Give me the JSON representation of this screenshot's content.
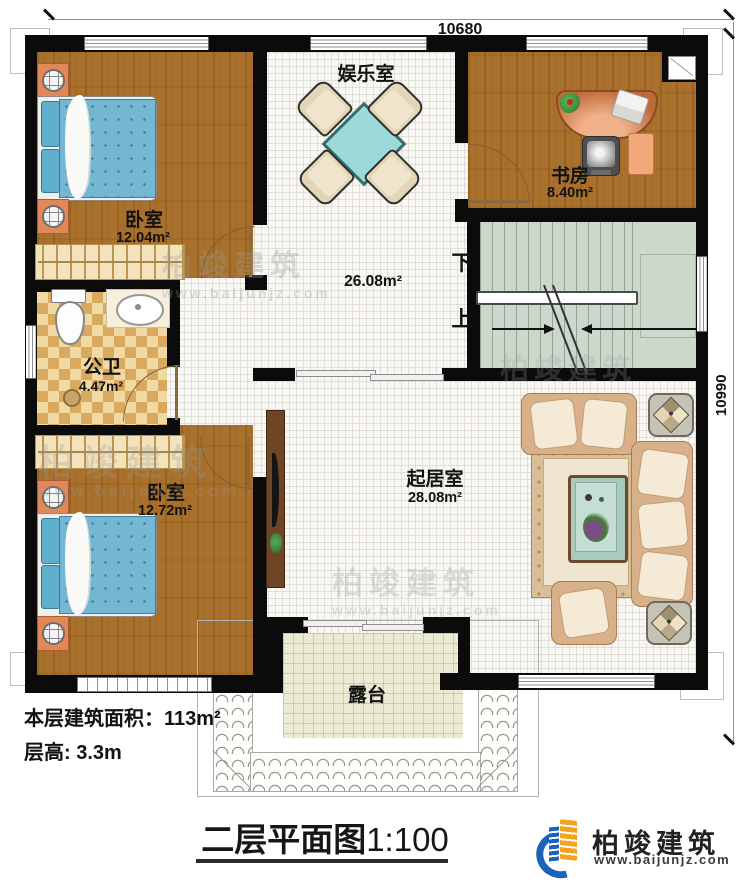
{
  "dimensions": {
    "top": "10680",
    "right": "10990"
  },
  "rooms": {
    "bedroom1": {
      "name": "卧室",
      "area": "12.04m²"
    },
    "entertainment": {
      "name": "娱乐室"
    },
    "study": {
      "name": "书房",
      "area": "8.40m²"
    },
    "hall": {
      "area": "26.08m²"
    },
    "bathroom": {
      "name": "公卫",
      "area": "4.47m²"
    },
    "bedroom2": {
      "name": "卧室",
      "area": "12.72m²"
    },
    "living": {
      "name": "起居室",
      "area": "28.08m²"
    },
    "terrace": {
      "name": "露台"
    }
  },
  "stairs": {
    "down": "下",
    "up": "上"
  },
  "info": {
    "floor_area": "本层建筑面积：113m²",
    "floor_height": "层高: 3.3m"
  },
  "title": {
    "text": "二层平面图",
    "scale": "1:100"
  },
  "brand": {
    "name": "柏竣建筑",
    "url": "www.baijunjz.com"
  },
  "watermark": {
    "name": "柏竣建筑",
    "url": "www.baijunjz.com"
  },
  "colors": {
    "wall": "#0b0b0b",
    "wood_floor": "#a9712c",
    "stair": "#cdd8cc",
    "bath_tile": "#d9a95f",
    "terrace": "#edead3",
    "bed_blue": "#74b7d2",
    "sofa_tan": "#d8b18a",
    "logo_blue": "#1c63b7",
    "logo_orange": "#f5a21c"
  }
}
